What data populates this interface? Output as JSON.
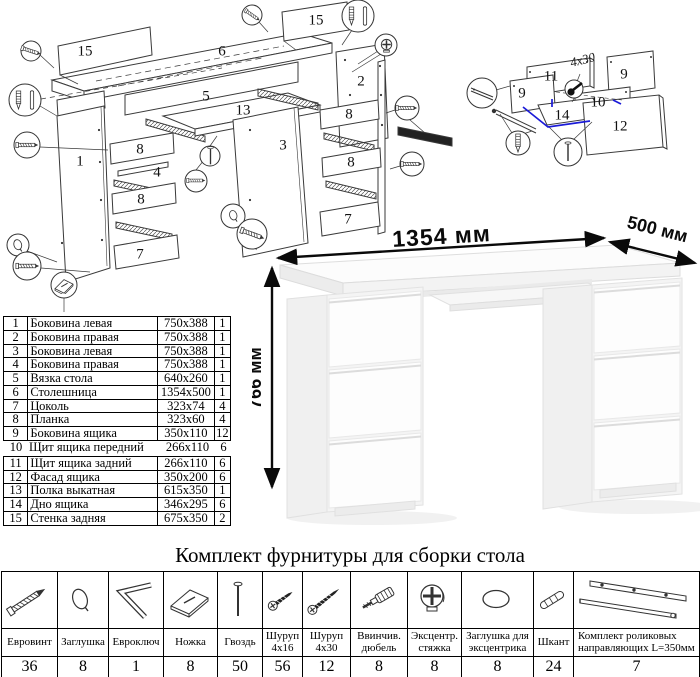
{
  "title": "Комплект фурнитуры для сборки стола",
  "desk": {
    "width_label": "1354 мм",
    "depth_label": "500 мм",
    "height_label": "766 мм"
  },
  "parts_table": {
    "rows": [
      {
        "num": "1",
        "name": "Боковина левая",
        "size": "750x388",
        "qty": "1"
      },
      {
        "num": "2",
        "name": "Боковина правая",
        "size": "750x388",
        "qty": "1"
      },
      {
        "num": "3",
        "name": "Боковина левая",
        "size": "750x388",
        "qty": "1"
      },
      {
        "num": "4",
        "name": "Боковина правая",
        "size": "750x388",
        "qty": "1"
      },
      {
        "num": "5",
        "name": "Вязка стола",
        "size": "640x260",
        "qty": "1"
      },
      {
        "num": "6",
        "name": "Столешница",
        "size": "1354x500",
        "qty": "1"
      },
      {
        "num": "7",
        "name": "Цоколь",
        "size": "323x74",
        "qty": "4"
      },
      {
        "num": "8",
        "name": "Планка",
        "size": "323x60",
        "qty": "4"
      },
      {
        "num": "9",
        "name": "Боковина ящика",
        "size": "350x110",
        "qty": "12"
      },
      {
        "num": "10",
        "name": "Щит ящика передний",
        "size": "266x110",
        "qty": "6"
      },
      {
        "num": "11",
        "name": "Щит ящика задний",
        "size": "266x110",
        "qty": "6"
      },
      {
        "num": "12",
        "name": "Фасад ящика",
        "size": "350x200",
        "qty": "6"
      },
      {
        "num": "13",
        "name": "Полка выкатная",
        "size": "615x350",
        "qty": "1"
      },
      {
        "num": "14",
        "name": "Дно ящика",
        "size": "346x295",
        "qty": "6"
      },
      {
        "num": "15",
        "name": "Стенка задняя",
        "size": "675x350",
        "qty": "2"
      }
    ]
  },
  "main_diagram": {
    "labels": [
      {
        "t": "15",
        "x": 85,
        "y": 52
      },
      {
        "t": "6",
        "x": 222,
        "y": 52
      },
      {
        "t": "15",
        "x": 316,
        "y": 21
      },
      {
        "t": "5",
        "x": 206,
        "y": 97
      },
      {
        "t": "13",
        "x": 243,
        "y": 111
      },
      {
        "t": "1",
        "x": 80,
        "y": 162
      },
      {
        "t": "8",
        "x": 140,
        "y": 150
      },
      {
        "t": "4",
        "x": 157,
        "y": 173
      },
      {
        "t": "8",
        "x": 141,
        "y": 200
      },
      {
        "t": "7",
        "x": 140,
        "y": 255
      },
      {
        "t": "3",
        "x": 283,
        "y": 146
      },
      {
        "t": "2",
        "x": 361,
        "y": 82
      },
      {
        "t": "8",
        "x": 349,
        "y": 115
      },
      {
        "t": "8",
        "x": 351,
        "y": 163
      },
      {
        "t": "7",
        "x": 348,
        "y": 220
      }
    ]
  },
  "drawer_diagram": {
    "annotation": "4x30",
    "labels": [
      {
        "t": "11",
        "x": 111,
        "y": 77
      },
      {
        "t": "9",
        "x": 184,
        "y": 75
      },
      {
        "t": "9",
        "x": 82,
        "y": 94
      },
      {
        "t": "10",
        "x": 158,
        "y": 103
      },
      {
        "t": "14",
        "x": 122,
        "y": 116
      },
      {
        "t": "12",
        "x": 180,
        "y": 127
      }
    ]
  },
  "hardware": {
    "items": [
      {
        "label": "Евровинт",
        "qty": "36",
        "icon": "confirmat-screw-icon"
      },
      {
        "label": "Заглушка",
        "qty": "8",
        "icon": "cap-plug-icon"
      },
      {
        "label": "Евроключ",
        "qty": "1",
        "icon": "hex-key-icon"
      },
      {
        "label": "Ножка",
        "qty": "8",
        "icon": "foot-icon"
      },
      {
        "label": "Гвоздь",
        "qty": "50",
        "icon": "nail-icon"
      },
      {
        "label": "Шуруп 4x16",
        "qty": "56",
        "icon": "screw-4x16-icon"
      },
      {
        "label": "Шуруп 4x30",
        "qty": "12",
        "icon": "screw-4x30-icon"
      },
      {
        "label": "Ввинчив. дюбель",
        "qty": "8",
        "icon": "screw-in-dowel-icon"
      },
      {
        "label": "Эксцентр. стяжка",
        "qty": "8",
        "icon": "cam-lock-icon"
      },
      {
        "label": "Заглушка для эксцентрика",
        "qty": "8",
        "icon": "cam-cover-icon"
      },
      {
        "label": "Шкант",
        "qty": "24",
        "icon": "wooden-dowel-icon"
      },
      {
        "label": "Комплект роликовых направляющих L=350мм",
        "qty": "7",
        "icon": "drawer-slides-icon"
      }
    ]
  },
  "colors": {
    "highlight_blue": "#1b1bd8",
    "line_art": "#3a3a3a"
  }
}
